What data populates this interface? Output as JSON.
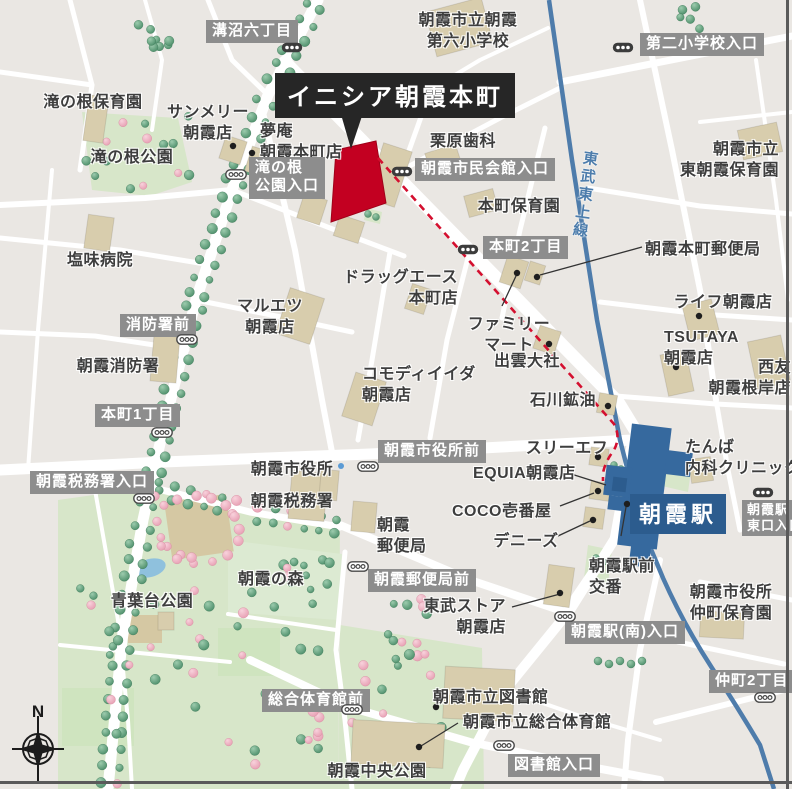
{
  "map": {
    "title": "イニシア朝霞本町",
    "station": {
      "name": "朝霞駅"
    },
    "railway": {
      "name": "東武東上線"
    },
    "compass": {
      "label": "N"
    },
    "colors": {
      "background": "#eae7e3",
      "road": "#ffffff",
      "building": "#d8cdad",
      "park": "#d7e6c9",
      "park_light": "#dcead2",
      "field_tan": "#d5c8a3",
      "sports_green": "#cfe4bf",
      "pond": "#8fc1dd",
      "tree_green": "#4e8f6b",
      "tree_pink": "#e79fb3",
      "railway_blue": "#4e7cab",
      "station_blue": "#36699e",
      "station_label_bg": "#2c5c8e",
      "route_red": "#d40f2f",
      "highlight_red": "#c30021",
      "label_gray_bg": "#8d8d8d",
      "title_bg": "#262626",
      "text": "#3e3e3e"
    },
    "places": [
      {
        "id": "asaka-dairoku-elementary",
        "lines": [
          "朝霞市立朝霞",
          "第六小学校"
        ],
        "x": 468,
        "y": 10,
        "align": "center"
      },
      {
        "id": "takinone-nursery",
        "lines": [
          "滝の根保育園"
        ],
        "x": 93,
        "y": 92,
        "align": "center"
      },
      {
        "id": "sunmerry-asaka",
        "lines": [
          "サンメリー",
          "朝霞店"
        ],
        "x": 208,
        "y": 102,
        "align": "center"
      },
      {
        "id": "yumean-asakahoncho",
        "lines": [
          "夢庵",
          "朝霞本町店"
        ],
        "x": 260,
        "y": 121,
        "align": "left"
      },
      {
        "id": "takinone-park",
        "lines": [
          "滝の根公園"
        ],
        "x": 132,
        "y": 147,
        "align": "center"
      },
      {
        "id": "kurihara-dental",
        "lines": [
          "栗原歯科"
        ],
        "x": 463,
        "y": 131,
        "align": "center"
      },
      {
        "id": "higashi-asaka-nursery",
        "lines": [
          "朝霞市立",
          "東朝霞保育園"
        ],
        "x": 779,
        "y": 139,
        "align": "right"
      },
      {
        "id": "honcho-nursery",
        "lines": [
          "本町保育園"
        ],
        "x": 519,
        "y": 196,
        "align": "center"
      },
      {
        "id": "shiomi-hospital",
        "lines": [
          "塩味病院"
        ],
        "x": 100,
        "y": 250,
        "align": "center"
      },
      {
        "id": "drug-ace-honcho",
        "lines": [
          "ドラッグエース",
          "本町店"
        ],
        "x": 458,
        "y": 267,
        "align": "right"
      },
      {
        "id": "maruetsu-asaka",
        "lines": [
          "マルエツ",
          "朝霞店"
        ],
        "x": 270,
        "y": 296,
        "align": "center"
      },
      {
        "id": "family-mart",
        "lines": [
          "ファミリー",
          "マート"
        ],
        "x": 509,
        "y": 314,
        "align": "center"
      },
      {
        "id": "izumo-taisha",
        "lines": [
          "出雲大社"
        ],
        "x": 527,
        "y": 351,
        "align": "center"
      },
      {
        "id": "life-asaka",
        "lines": [
          "ライフ朝霞店"
        ],
        "x": 723,
        "y": 292,
        "align": "center"
      },
      {
        "id": "tsutaya-asaka",
        "lines": [
          "TSUTAYA",
          "朝霞店"
        ],
        "x": 664,
        "y": 327,
        "align": "left"
      },
      {
        "id": "seiyu-asakanegishi",
        "lines": [
          "西友",
          "朝霞根岸店"
        ],
        "x": 791,
        "y": 357,
        "align": "right"
      },
      {
        "id": "asaka-fire-station",
        "lines": [
          "朝霞消防署"
        ],
        "x": 118,
        "y": 356,
        "align": "center"
      },
      {
        "id": "komodi-iida",
        "lines": [
          "コモディイイダ",
          "朝霞店"
        ],
        "x": 362,
        "y": 364,
        "align": "left"
      },
      {
        "id": "asakahoncho-post-office",
        "lines": [
          "朝霞本町郵便局"
        ],
        "x": 645,
        "y": 239,
        "align": "left"
      },
      {
        "id": "ishikawa-koyu",
        "lines": [
          "石川鉱油"
        ],
        "x": 596,
        "y": 390,
        "align": "right"
      },
      {
        "id": "asaka-city-hall",
        "lines": [
          "朝霞市役所"
        ],
        "x": 292,
        "y": 459,
        "align": "center"
      },
      {
        "id": "asaka-tax-office",
        "lines": [
          "朝霞税務署"
        ],
        "x": 292,
        "y": 491,
        "align": "center"
      },
      {
        "id": "three-f",
        "lines": [
          "スリーエフ"
        ],
        "x": 567,
        "y": 438,
        "align": "center"
      },
      {
        "id": "equia-asaka",
        "lines": [
          "EQUIA朝霞店"
        ],
        "x": 473,
        "y": 463,
        "align": "left"
      },
      {
        "id": "coco-ichibanya",
        "lines": [
          "COCO壱番屋"
        ],
        "x": 452,
        "y": 501,
        "align": "left"
      },
      {
        "id": "dennys",
        "lines": [
          "デニーズ"
        ],
        "x": 526,
        "y": 531,
        "align": "center"
      },
      {
        "id": "asaka-post-office",
        "lines": [
          "朝霞",
          "郵便局"
        ],
        "x": 377,
        "y": 515,
        "align": "left"
      },
      {
        "id": "ekimae-koban",
        "lines": [
          "朝霞駅前",
          "交番"
        ],
        "x": 589,
        "y": 556,
        "align": "left"
      },
      {
        "id": "tanba-clinic",
        "lines": [
          "たんば",
          "内科クリニック"
        ],
        "x": 685,
        "y": 437,
        "align": "left"
      },
      {
        "id": "nakacho-nursery",
        "lines": [
          "朝霞市役所",
          "仲町保育園"
        ],
        "x": 731,
        "y": 582,
        "align": "center"
      },
      {
        "id": "aobadai-park",
        "lines": [
          "青葉台公園"
        ],
        "x": 152,
        "y": 591,
        "align": "center"
      },
      {
        "id": "asaka-no-mori",
        "lines": [
          "朝霞の森"
        ],
        "x": 271,
        "y": 569,
        "align": "center"
      },
      {
        "id": "tobu-store",
        "lines": [
          "東武ストア",
          "朝霞店"
        ],
        "x": 506,
        "y": 596,
        "align": "right"
      },
      {
        "id": "asaka-library",
        "lines": [
          "朝霞市立図書館"
        ],
        "x": 433,
        "y": 687,
        "align": "left"
      },
      {
        "id": "asaka-gymnasium",
        "lines": [
          "朝霞市立総合体育館"
        ],
        "x": 463,
        "y": 712,
        "align": "left"
      },
      {
        "id": "asaka-chuo-park",
        "lines": [
          "朝霞中央公園"
        ],
        "x": 377,
        "y": 761,
        "align": "center"
      }
    ],
    "bus_stops": [
      {
        "id": "mizonuma-6",
        "lines": [
          "溝沼六丁目"
        ],
        "style": "dark",
        "box": {
          "x": 206,
          "y": 20
        },
        "icon": {
          "x": 292,
          "y": 45
        }
      },
      {
        "id": "daini-shogakko-iriguchi",
        "lines": [
          "第二小学校入口"
        ],
        "style": "dark",
        "box": {
          "x": 640,
          "y": 33
        },
        "icon": {
          "x": 623,
          "y": 45
        }
      },
      {
        "id": "takinone-koen-iriguchi",
        "lines": [
          "滝の根",
          "公園入口"
        ],
        "style": "light",
        "box": {
          "x": 249,
          "y": 157
        },
        "icon": {
          "x": 236,
          "y": 172
        }
      },
      {
        "id": "shimin-kaikan-iriguchi",
        "lines": [
          "朝霞市民会館入口"
        ],
        "style": "dark",
        "box": {
          "x": 415,
          "y": 158
        },
        "icon": {
          "x": 402,
          "y": 169
        }
      },
      {
        "id": "honcho-2-chome",
        "lines": [
          "本町2丁目"
        ],
        "style": "dark",
        "box": {
          "x": 483,
          "y": 236
        },
        "icon": {
          "x": 468,
          "y": 247
        }
      },
      {
        "id": "shobosho-mae",
        "lines": [
          "消防署前"
        ],
        "style": "light",
        "box": {
          "x": 120,
          "y": 314
        },
        "icon": {
          "x": 187,
          "y": 337
        }
      },
      {
        "id": "honcho-1-chome",
        "lines": [
          "本町1丁目"
        ],
        "style": "light",
        "box": {
          "x": 95,
          "y": 404
        },
        "icon": {
          "x": 162,
          "y": 430
        }
      },
      {
        "id": "zeimusho-iriguchi",
        "lines": [
          "朝霞税務署入口"
        ],
        "style": "light",
        "box": {
          "x": 30,
          "y": 471
        },
        "icon": {
          "x": 144,
          "y": 496
        }
      },
      {
        "id": "shiyakusho-mae",
        "lines": [
          "朝霞市役所前"
        ],
        "style": "light",
        "box": {
          "x": 378,
          "y": 440
        },
        "icon": {
          "x": 368,
          "y": 464
        }
      },
      {
        "id": "yubinkyoku-mae",
        "lines": [
          "朝霞郵便局前"
        ],
        "style": "light",
        "box": {
          "x": 368,
          "y": 569
        },
        "icon": {
          "x": 358,
          "y": 564
        }
      },
      {
        "id": "higashiguchi-iriguchi",
        "lines": [
          "朝霞駅",
          "東口入口"
        ],
        "style": "dark",
        "small": true,
        "box": {
          "x": 742,
          "y": 500
        },
        "icon": {
          "x": 763,
          "y": 490
        }
      },
      {
        "id": "minami-iriguchi",
        "lines": [
          "朝霞駅(南)入口"
        ],
        "style": "light",
        "box": {
          "x": 565,
          "y": 621
        },
        "icon": {
          "x": 565,
          "y": 614
        }
      },
      {
        "id": "nakacho-2-chome",
        "lines": [
          "仲町2丁目"
        ],
        "style": "light",
        "box": {
          "x": 709,
          "y": 670
        },
        "icon": {
          "x": 765,
          "y": 695
        }
      },
      {
        "id": "sogo-taiikukan-mae",
        "lines": [
          "総合体育館前"
        ],
        "style": "light",
        "box": {
          "x": 262,
          "y": 689
        },
        "icon": {
          "x": 352,
          "y": 707
        }
      },
      {
        "id": "toshokan-iriguchi",
        "lines": [
          "図書館入口"
        ],
        "style": "light",
        "box": {
          "x": 508,
          "y": 754
        },
        "icon": {
          "x": 504,
          "y": 743
        }
      }
    ]
  }
}
